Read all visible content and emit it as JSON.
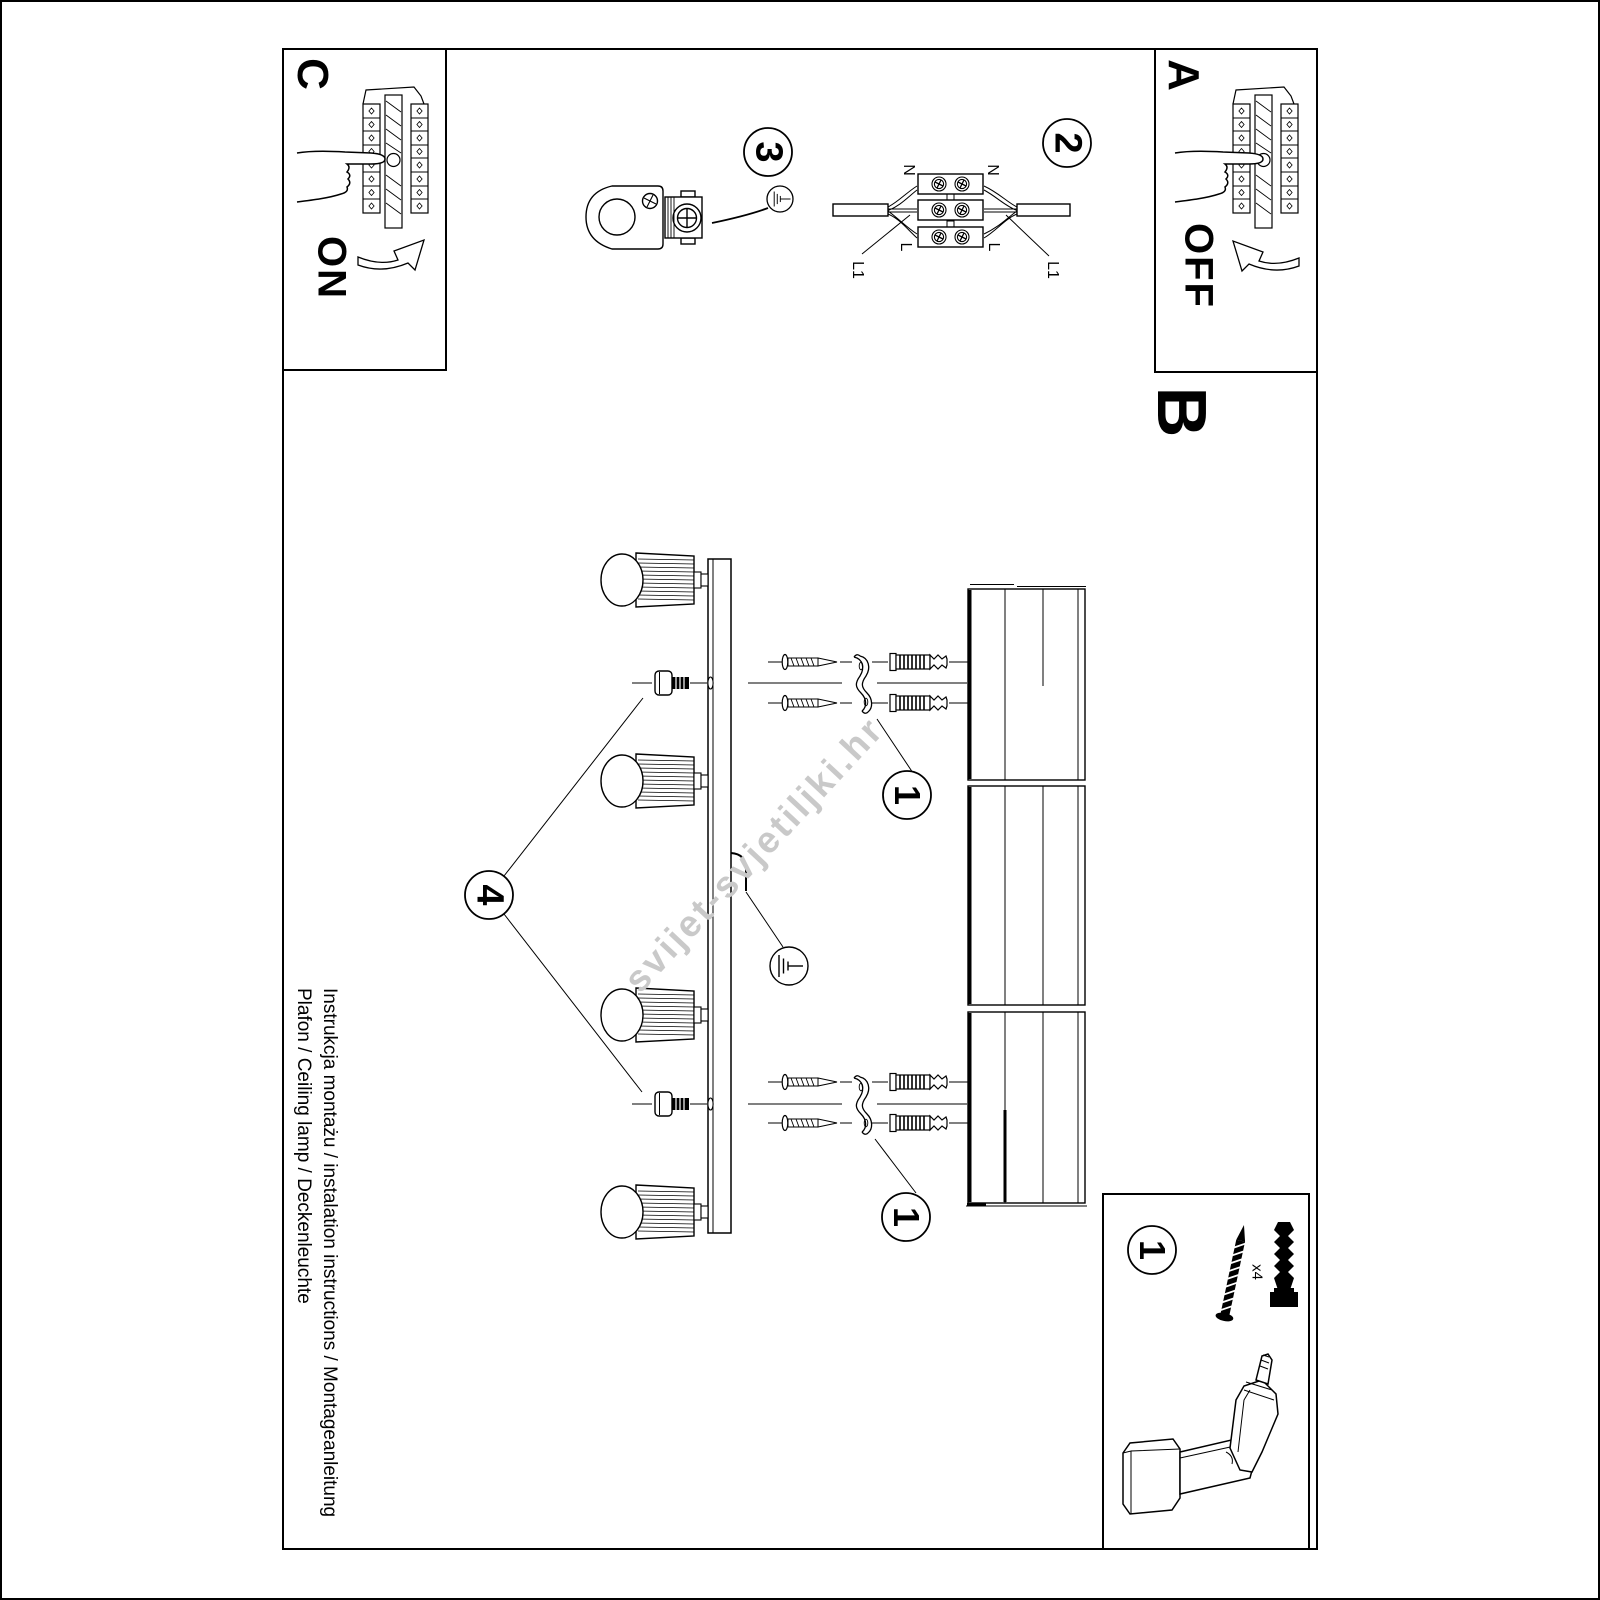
{
  "colors": {
    "ink": "#000000",
    "paper": "#ffffff",
    "watermark": "#c9c9c9"
  },
  "labels": {
    "c": "C",
    "on": "ON",
    "a": "A",
    "off": "OFF",
    "b": "B"
  },
  "steps": {
    "s1_top": "1",
    "s1_bottom": "1",
    "s1_parts": "1",
    "s2": "2",
    "s3": "3",
    "s4": "4"
  },
  "wiring": {
    "n_left": "N",
    "n_right": "N",
    "l_left": "L",
    "l_right": "L",
    "l1_left": "L1",
    "l1_right": "L1"
  },
  "parts": {
    "anchor_qty": "x4"
  },
  "footer": {
    "line1": "Instrukcja montażu / instalation instructions / Montageanleitung",
    "line2": "Plafon / Ceiling lamp / Deckenleuchte"
  },
  "watermark": {
    "text": "svijet-svjetiljki.hr"
  }
}
